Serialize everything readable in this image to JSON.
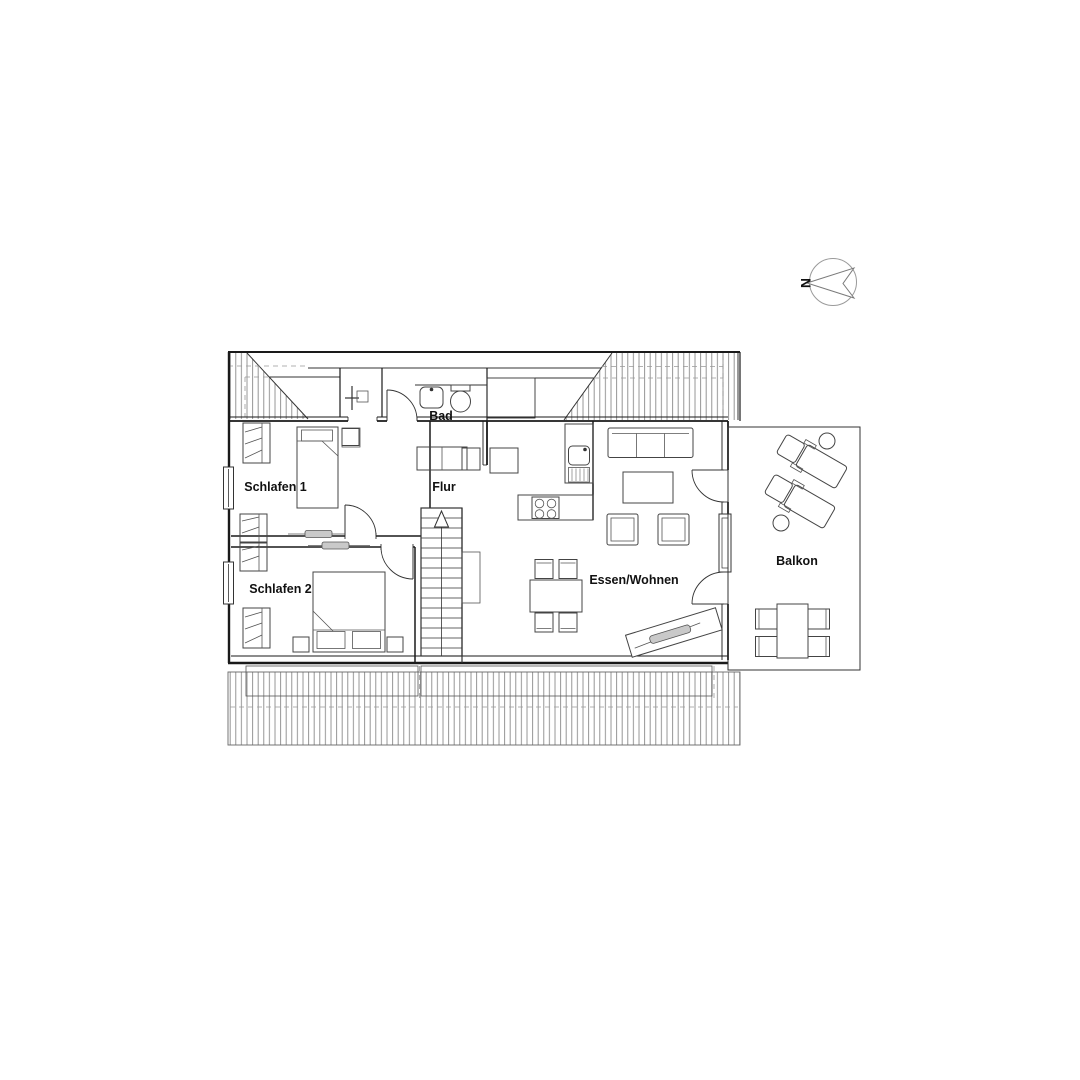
{
  "plan": {
    "title": "attic-floorplan",
    "north_label": "N",
    "rooms": {
      "schlafen1": "Schlafen 1",
      "schlafen2": "Schlafen 2",
      "bad": "Bad",
      "flur": "Flur",
      "essen_wohnen": "Essen/Wohnen",
      "balkon": "Balkon"
    },
    "colors": {
      "wall": "#1a1a1a",
      "hatch": "#8a8a8a",
      "dashed": "#999999",
      "slider_fill": "#c9c9c9",
      "background": "#ffffff"
    }
  }
}
